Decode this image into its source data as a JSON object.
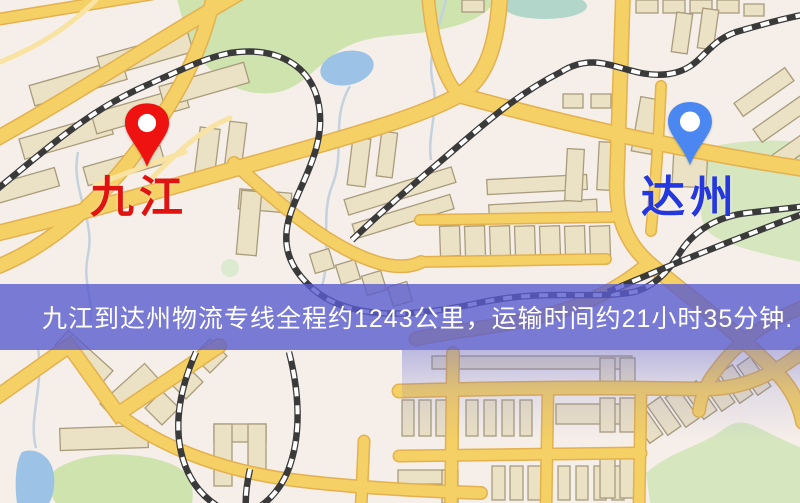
{
  "map": {
    "origin": {
      "label": "九江",
      "pin_color": "#ee1310",
      "label_color": "#e01310"
    },
    "destination": {
      "label": "达州",
      "pin_color": "#4b87f0",
      "label_color": "#2438dd"
    }
  },
  "banner": {
    "text": "九江到达州物流专线全程约1243公里，运输时间约21小时35分钟.",
    "origin": "九江",
    "destination": "达州",
    "service_type": "物流专线",
    "distance_km": "1243",
    "transit_time": "21小时35分钟",
    "overlay_color": "rgba(90,93,206,0.8)",
    "text_color": "#ffffff"
  },
  "map_style": {
    "background": "#f6efe9",
    "road_fill": "#f5d065",
    "road_casing": "#e3b14f",
    "building_fill": "#ebe1c5",
    "building_outline": "#a89c7c",
    "park_fill": "#cfe3ae",
    "water_fill": "#9cc2e6",
    "railway_color": "#3a3a3a"
  }
}
